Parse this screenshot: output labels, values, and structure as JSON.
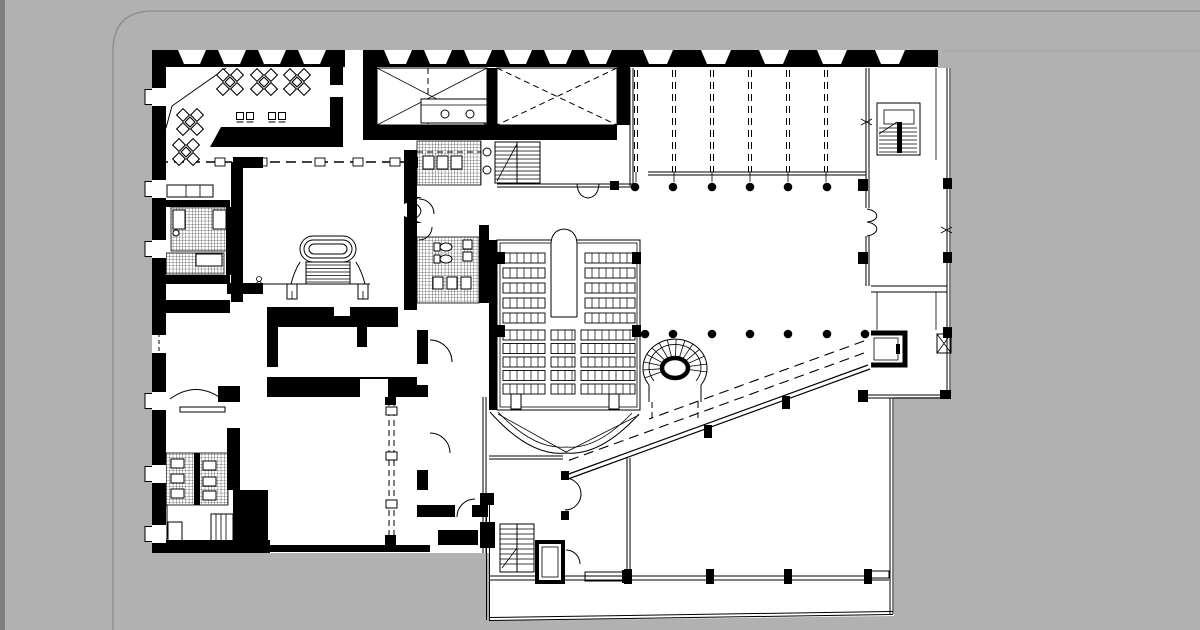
{
  "page": {
    "background_color": "#b1b1b1",
    "ink_color": "#000000",
    "paper_color": "#ffffff",
    "border_line_color": "#8c8c8c",
    "left_edge_strip_color": "#7e7e7e",
    "image_edge_line_color": "#a3a3a3",
    "corner_radius": 40,
    "border_left_x": 113,
    "border_top_y": 11,
    "image_top_edge": {
      "x1": 943,
      "y": 51,
      "x2": 1200
    }
  },
  "plan": {
    "kind": "architectural ground floor plan, black ink on white",
    "features": [
      "cafe-with-tables",
      "bar-counter",
      "entrance-vestibule",
      "kitchen-with-skylights",
      "wc-blocks",
      "grand-oval-staircase",
      "auditorium-with-seating",
      "spiral-staircase",
      "column-grid-hall",
      "diagonal-ramp",
      "elevators",
      "side-stairs",
      "glazed-foyer-extension"
    ],
    "top_band": {
      "y": 50,
      "h": 17,
      "left": {
        "x0": 152,
        "x1": 628,
        "centers": [
          192,
          232,
          272,
          312,
          398,
          438,
          478,
          518,
          558,
          598
        ],
        "top_w": 28,
        "bot_w": 16
      },
      "right": {
        "x0": 628,
        "x1": 938,
        "centers": [
          658,
          716,
          774,
          832,
          890
        ],
        "top_w": 30,
        "bot_w": 18
      },
      "entrance_gap": {
        "x": 345,
        "w": 18
      }
    },
    "left_windows": {
      "wall_x": 152,
      "wall_w": 14,
      "h": 18,
      "ys": [
        88,
        180,
        240,
        335,
        392,
        465,
        525
      ],
      "dashed_ys": [
        335
      ]
    },
    "hall": {
      "mullions_x": [
        636,
        674,
        712,
        750,
        788,
        826
      ],
      "mullion_y0": 70,
      "mullion_y1": 172,
      "beam_y": [
        172,
        175
      ],
      "beam_x0": 648,
      "beam_x1": 866,
      "columns": [
        {
          "y": 187,
          "x": [
            635,
            673,
            712,
            750,
            788,
            827
          ]
        },
        {
          "y": 334,
          "x": [
            645,
            673,
            712,
            750,
            788,
            827,
            865
          ]
        }
      ],
      "dot_r": 4.3
    },
    "cafe": {
      "tables": [
        [
          230,
          82
        ],
        [
          264,
          82
        ],
        [
          297,
          82
        ],
        [
          190,
          122
        ],
        [
          186,
          152
        ]
      ],
      "stools": [
        [
          240,
          116
        ],
        [
          250,
          116
        ],
        [
          272,
          116
        ],
        [
          282,
          116
        ]
      ]
    },
    "auditorium": {
      "rows_top": {
        "y0": 253,
        "pitch": 15,
        "n": 5,
        "h": 10,
        "banks": [
          [
            503,
            545
          ],
          [
            585,
            635
          ]
        ]
      },
      "rows_bottom": {
        "y0": 330,
        "pitch": 13.5,
        "n": 5,
        "h": 10,
        "banks": [
          [
            503,
            545
          ],
          [
            551,
            575
          ],
          [
            581,
            635
          ]
        ]
      },
      "seat_step": 7
    },
    "corridor_dash_line": {
      "y": 162,
      "x0": 158,
      "x1": 417,
      "ties_x": [
        220,
        262,
        320,
        358,
        395
      ]
    },
    "extension": {
      "posts_x": [
        628,
        710,
        788,
        868
      ],
      "post_y": 569,
      "mullion_y": 576.5
    },
    "ramp": {
      "dashed": [
        [
          864,
          341,
          649,
          419
        ],
        [
          864,
          353,
          567,
          461
        ]
      ],
      "solid": [
        [
          868,
          365,
          566,
          475
        ],
        [
          870,
          369,
          568,
          479
        ]
      ],
      "posts": [
        [
          786,
          396
        ],
        [
          708,
          425
        ]
      ]
    }
  }
}
